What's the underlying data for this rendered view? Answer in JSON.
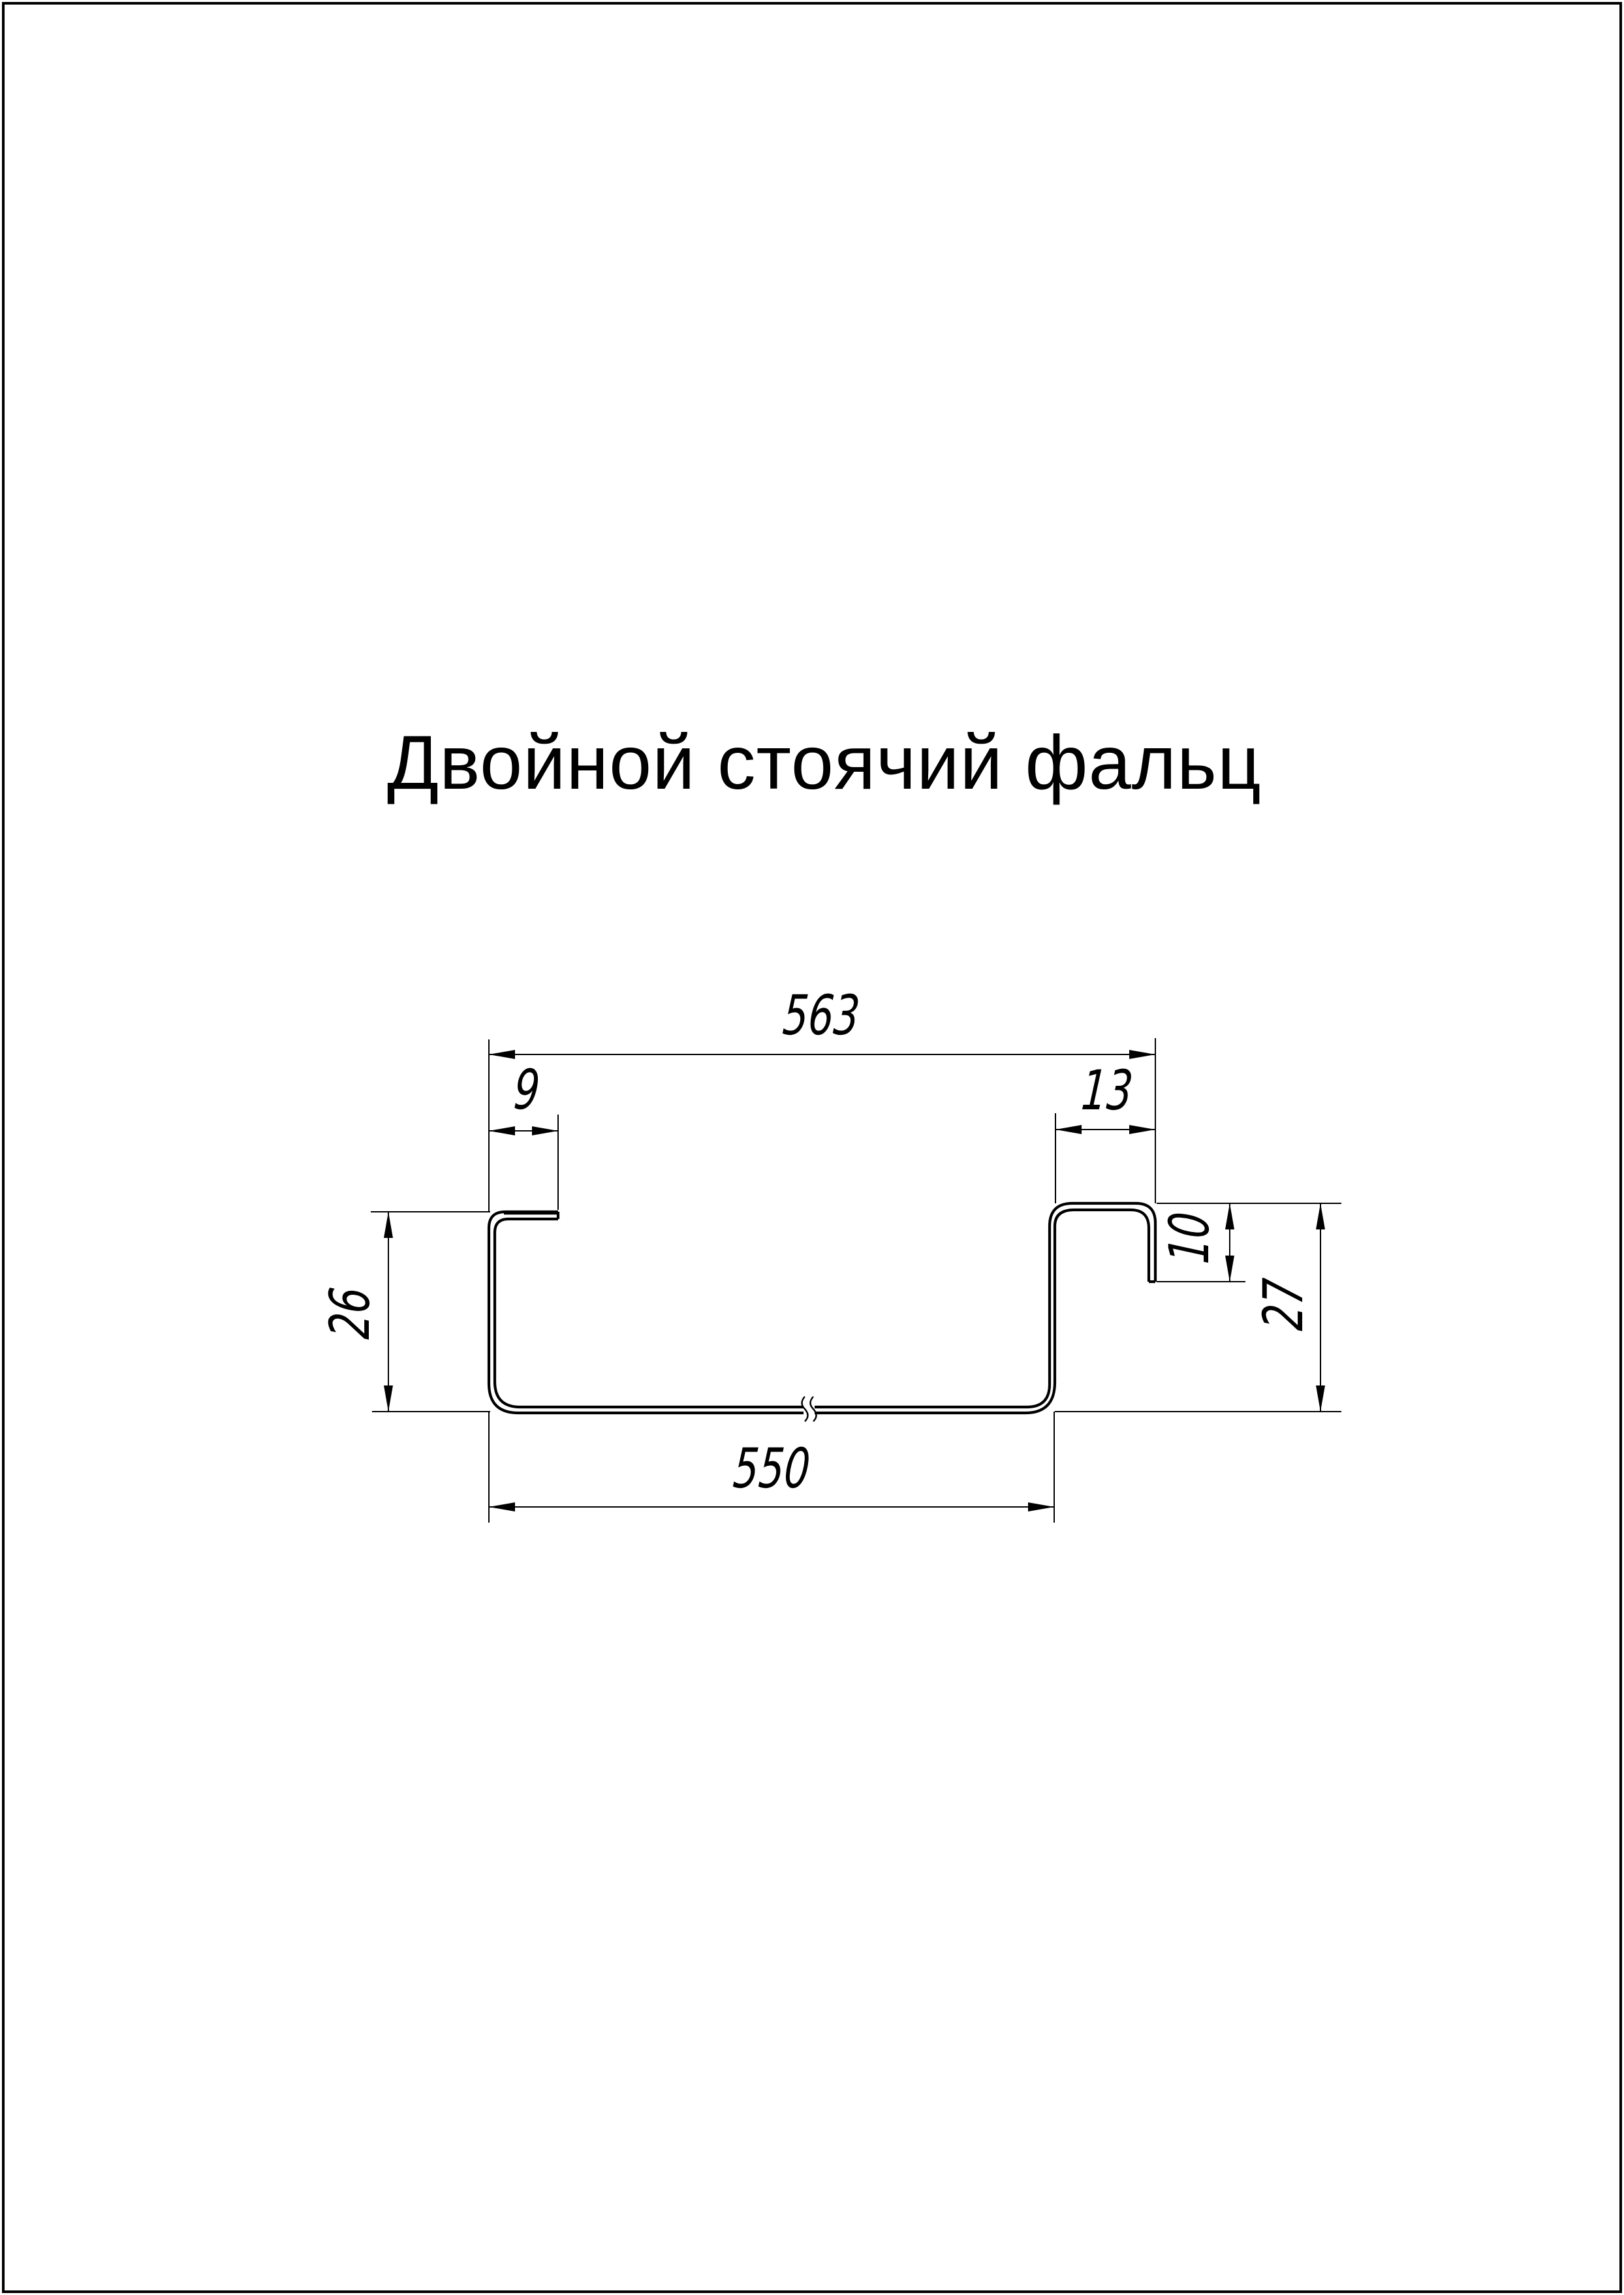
{
  "page": {
    "title": "Двойной стоячий фальц",
    "background_color": "#ffffff",
    "line_color": "#000000"
  },
  "drawing": {
    "kind": "sheet-metal seam profile cross-section with break mark",
    "dimensions": {
      "overall_width": "563",
      "left_lip_width": "9",
      "right_hook_width": "13",
      "right_hook_depth": "10",
      "left_height": "26",
      "right_height": "27",
      "bottom_width": "550"
    }
  }
}
